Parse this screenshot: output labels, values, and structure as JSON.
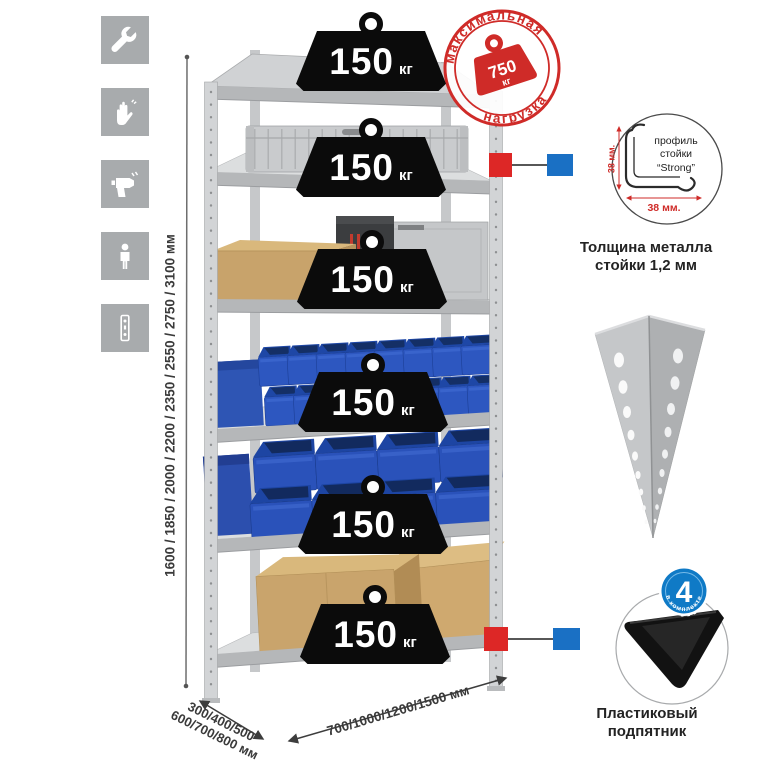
{
  "sidebar": {
    "icons": [
      {
        "name": "wrench-icon"
      },
      {
        "name": "gloves-icon"
      },
      {
        "name": "drill-icon"
      },
      {
        "name": "person-icon"
      },
      {
        "name": "rack-post-icon"
      }
    ]
  },
  "dimensions": {
    "height_label": "1600 / 1850 / 2000 / 2200 / 2350 / 2550 / 2750 / 3100 мм",
    "depth_label_line1": "300/400/500",
    "depth_label_line2": "600/700/800 мм",
    "width_label": "700/1000/1200/1500 мм"
  },
  "shelves": [
    {
      "load_value": "150",
      "load_unit": "кг"
    },
    {
      "load_value": "150",
      "load_unit": "кг"
    },
    {
      "load_value": "150",
      "load_unit": "кг"
    },
    {
      "load_value": "150",
      "load_unit": "кг"
    },
    {
      "load_value": "150",
      "load_unit": "кг"
    },
    {
      "load_value": "150",
      "load_unit": "кг"
    }
  ],
  "max_load_stamp": {
    "arc_top": "максимальная",
    "arc_bottom": "нагрузка",
    "value": "750",
    "unit": "кг"
  },
  "profile_detail": {
    "label_line1": "профиль",
    "label_line2": "стойки",
    "label_line3": "“Strong”",
    "dim_vertical": "38 мм.",
    "dim_horizontal": "38 мм.",
    "caption_line1": "Толщина металла",
    "caption_line2": "стойки 1,2 мм"
  },
  "foot_detail": {
    "badge_value": "4",
    "badge_text": "в комплекте",
    "caption_line1": "Пластиковый",
    "caption_line2": "подпятник"
  },
  "colors": {
    "stamp_red": "#cf2b28",
    "marker_red": "#dd2726",
    "marker_blue": "#1a70c4",
    "badge_blue": "#0f7ac6",
    "bin_blue": "#2b55bd",
    "cardboard_tan": "#c8a36b",
    "metal_gray": "#c6c8ca",
    "tile_gray": "#a8abad",
    "weight_black": "#0b0b0b"
  }
}
